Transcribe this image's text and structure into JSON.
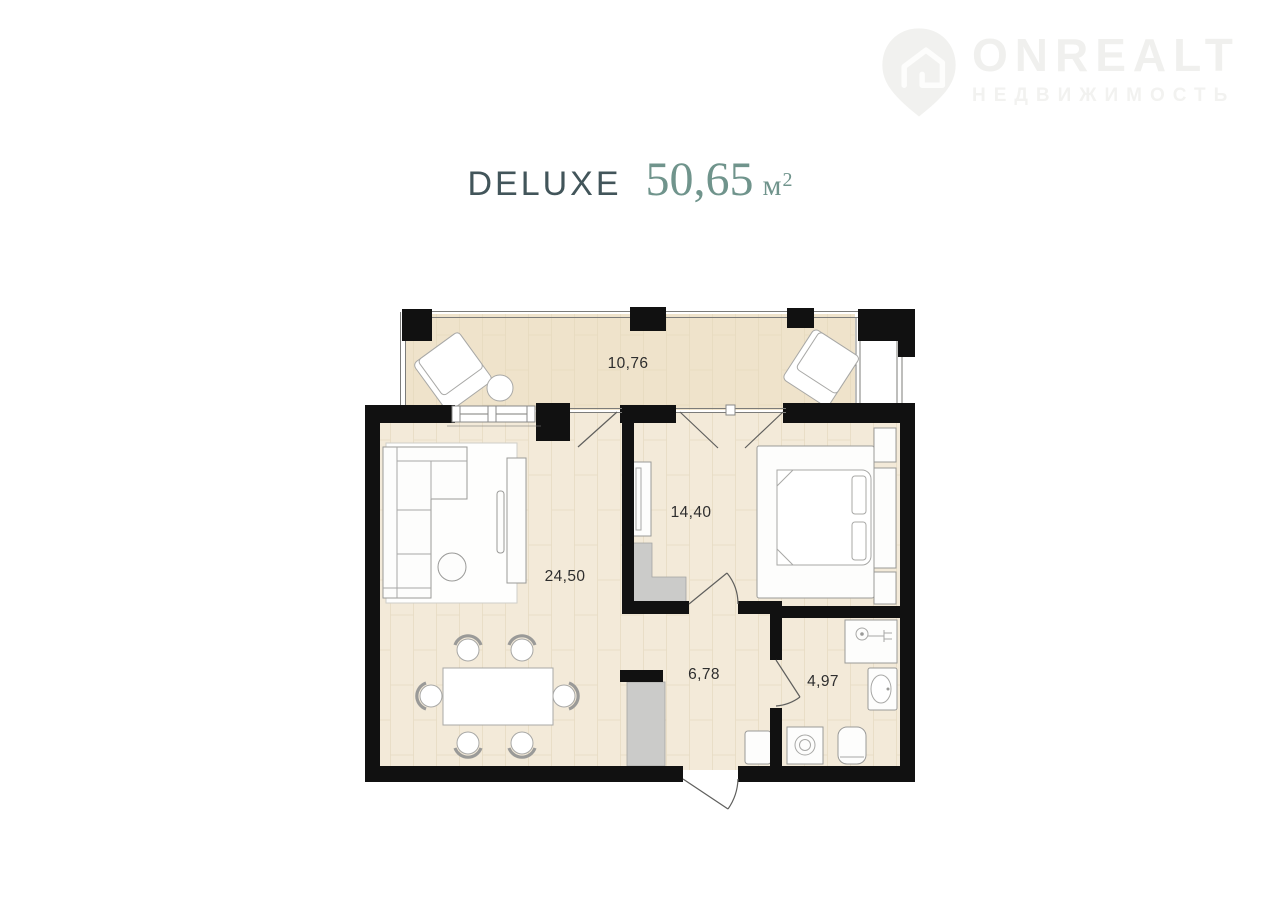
{
  "brand": {
    "name": "ONREALT",
    "tagline": "НЕДВИЖИМОСТЬ",
    "logo_icon": "location-pin-house-icon",
    "watermark_color": "#f0f0ee"
  },
  "title": {
    "plan_name": "DELUXE",
    "area_value": "50,65",
    "area_unit": "м",
    "area_sup": "2",
    "name_color": "#42555a",
    "area_color": "#70948c"
  },
  "floor_plan": {
    "total_area": "50,65",
    "rooms": [
      {
        "name": "balcony",
        "area": "10,76"
      },
      {
        "name": "living-room",
        "area": "24,50"
      },
      {
        "name": "bedroom",
        "area": "14,40"
      },
      {
        "name": "hallway",
        "area": "6,78"
      },
      {
        "name": "bathroom",
        "area": "4,97"
      }
    ],
    "colors": {
      "walls": "#111111",
      "floor": "#f3ead9",
      "balcony_floor": "#efe3cb",
      "closets": "#cbcbc9",
      "furniture_outline": "#9a9a98",
      "labels": "#2e2e2e"
    }
  }
}
